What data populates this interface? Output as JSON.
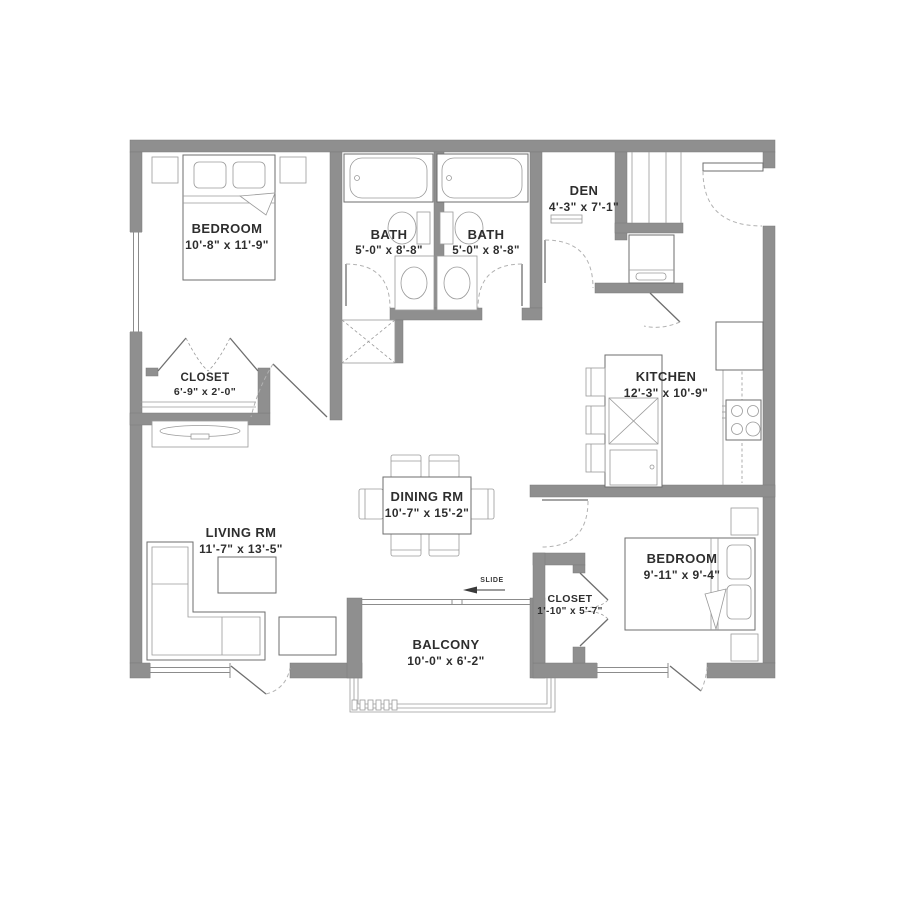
{
  "plan": {
    "title": "2 Bedroom 2 Bath Floor Plan",
    "wall_color": "#8f8f8f",
    "line_color": "#6e6e6e",
    "text_color": "#2e2e2e",
    "background": "#ffffff"
  },
  "rooms": [
    {
      "id": "bedroom-1",
      "name": "BEDROOM",
      "dims": "10'-8\" x 11'-9\""
    },
    {
      "id": "bath-1",
      "name": "BATH",
      "dims": "5'-0\" x 8'-8\""
    },
    {
      "id": "bath-2",
      "name": "BATH",
      "dims": "5'-0\" x 8'-8\""
    },
    {
      "id": "den",
      "name": "DEN",
      "dims": "4'-3\" x 7'-1\""
    },
    {
      "id": "closet-1",
      "name": "CLOSET",
      "dims": "6'-9\" x 2'-0\""
    },
    {
      "id": "kitchen",
      "name": "KITCHEN",
      "dims": "12'-3\" x 10'-9\""
    },
    {
      "id": "dining-room",
      "name": "DINING RM",
      "dims": "10'-7\" x 15'-2\""
    },
    {
      "id": "living-room",
      "name": "LIVING RM",
      "dims": "11'-7\" x 13'-5\""
    },
    {
      "id": "bedroom-2",
      "name": "BEDROOM",
      "dims": "9'-11\" x 9'-4\""
    },
    {
      "id": "closet-2",
      "name": "CLOSET",
      "dims": "1'-10\" x 5'-7\""
    },
    {
      "id": "balcony",
      "name": "BALCONY",
      "dims": "10'-0\" x 6'-2\""
    }
  ],
  "annotations": {
    "slide_label": "SLIDE"
  }
}
